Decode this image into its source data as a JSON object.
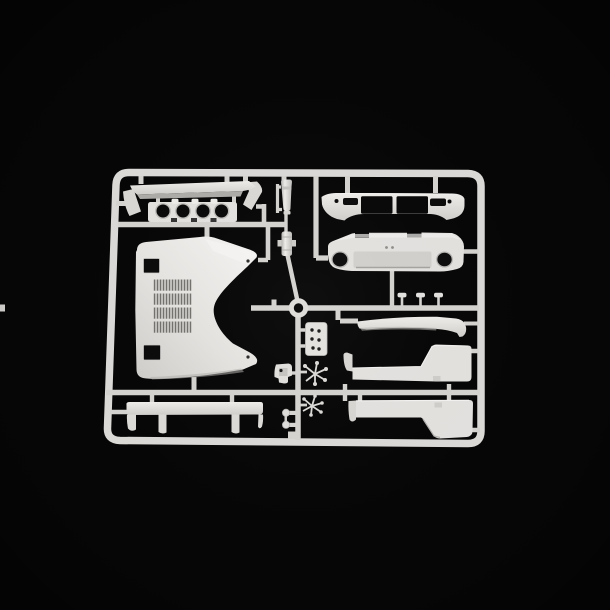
{
  "scene": {
    "type": "product-photograph",
    "description": "Injection-moulded white polystyrene model-kit sprue (parts tree) holding car body panels, photographed on a black background",
    "background_label": "black studio backdrop",
    "material_label": "white styrene plastic"
  },
  "colors": {
    "background": "#060606",
    "frame": "#dcdad7",
    "runner": "#d5d3d0",
    "plastic_bright": "#f2f1ee",
    "plastic_base": "#e4e2df",
    "plastic_mid": "#d2d0cd",
    "plastic_shadow": "#bbb9b6",
    "plastic_dark": "#9d9b98",
    "cutout": "#0a0a0a"
  },
  "sprue": {
    "frame_shape": "rounded rectangular runner frame",
    "parts": [
      {
        "id": "rear-wing",
        "label": "Rear wing blade with angled end plates"
      },
      {
        "id": "headlamp-panel",
        "label": "Front panel with four round headlamp openings"
      },
      {
        "id": "hood",
        "label": "Large louvered hood / engine cover with concave cowl cutout and two square openings"
      },
      {
        "id": "tail-panel",
        "label": "Tail panel with two large rectangular lamp openings and small end openings"
      },
      {
        "id": "rear-bumper",
        "label": "Rear bumper with two oval recesses and licence-plate recess"
      },
      {
        "id": "front-spoiler",
        "label": "Front spoiler lip with folded end"
      },
      {
        "id": "side-skirt-upper",
        "label": "Side sill panel, right hand"
      },
      {
        "id": "side-skirt-lower",
        "label": "Side sill panel, left hand"
      },
      {
        "id": "rear-valance",
        "label": "Lower valance with two arch cutouts"
      },
      {
        "id": "intake-cone",
        "label": "Small tapered intake / exhaust tip"
      },
      {
        "id": "small-cylinder",
        "label": "Small cylindrical canister part"
      },
      {
        "id": "hinge-plate",
        "label": "Small plate with six locating holes"
      },
      {
        "id": "bracket",
        "label": "Small box bracket with locating hole"
      },
      {
        "id": "micro-parts-a",
        "label": "Radial cluster of tiny parts"
      },
      {
        "id": "micro-parts-b",
        "label": "Radial cluster of tiny parts"
      },
      {
        "id": "rivet-details",
        "label": "Two small rivet / bolt details"
      },
      {
        "id": "t-clips",
        "label": "Three small T-headed details"
      },
      {
        "id": "locator-ring",
        "label": "Round sprue locator ring"
      }
    ]
  }
}
